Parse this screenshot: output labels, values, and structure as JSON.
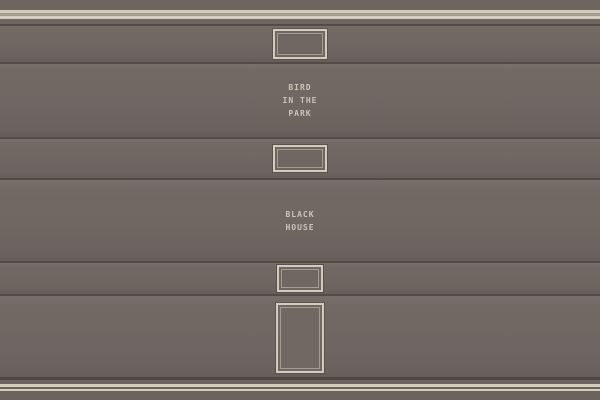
{
  "bands": [
    {
      "kind": "plate",
      "plate_icon": "framed-label-plate"
    },
    {
      "kind": "title",
      "title": "BIRD\nIN THE\nPARK"
    },
    {
      "kind": "plate",
      "plate_icon": "framed-label-plate"
    },
    {
      "kind": "title",
      "title": "BLACK\nHOUSE"
    },
    {
      "kind": "plate",
      "plate_icon": "framed-label-plate"
    },
    {
      "kind": "tall-panel",
      "plate_icon": "framed-tall-panel"
    }
  ],
  "colors": {
    "band_base": "#6f6762",
    "band_highlight": "#776f6a",
    "band_shadow": "#655d59",
    "seam": "#524c46",
    "trim_cream": "#d3ccbc",
    "trim_taupe": "#a59d91",
    "plate_frame": "#d3ccbc",
    "plate_outline": "#59534d",
    "plate_inner_line": "#a49c90",
    "title_text": "#ccc5b5"
  }
}
